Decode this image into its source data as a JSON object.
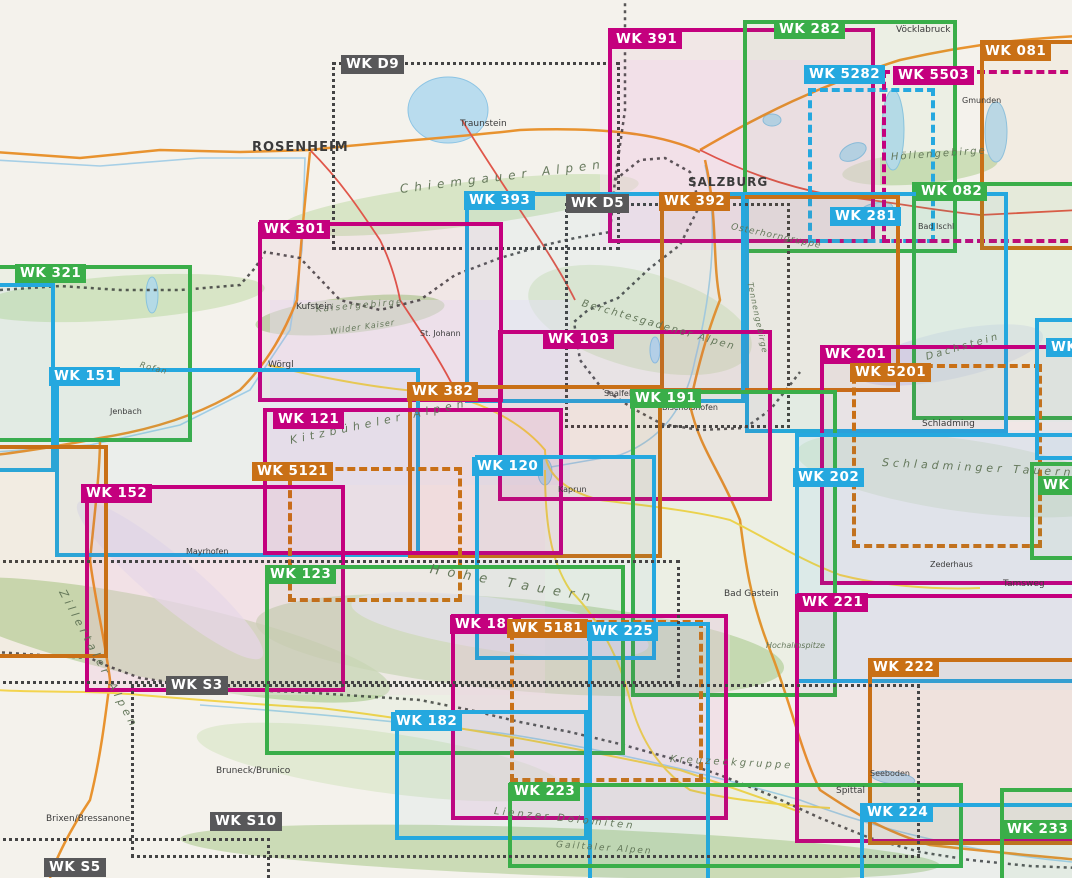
{
  "palette": {
    "magenta": "#c4007e",
    "green": "#3aae49",
    "cyan": "#25a8df",
    "orange": "#c97016",
    "gray": "#58585a",
    "label_text": "#ffffff",
    "water": "#b9dcee",
    "border_line": "#3c3c3c"
  },
  "sheets": [
    {
      "id": "wk-d9",
      "label": "WK D9",
      "color": "gray",
      "style": "dotted",
      "box": [
        332,
        62,
        288,
        188
      ],
      "label_pos": [
        341,
        55
      ]
    },
    {
      "id": "wk-391",
      "label": "WK 391",
      "color": "magenta",
      "style": "solid",
      "box": [
        608,
        28,
        267,
        215
      ],
      "label_pos": [
        611,
        30
      ]
    },
    {
      "id": "wk-282",
      "label": "WK 282",
      "color": "green",
      "style": "solid",
      "box": [
        743,
        20,
        214,
        233
      ],
      "label_pos": [
        774,
        20
      ]
    },
    {
      "id": "wk-5282",
      "label": "WK 5282",
      "color": "cyan",
      "style": "dashed",
      "box": [
        808,
        88,
        127,
        155
      ],
      "label_pos": [
        804,
        65
      ]
    },
    {
      "id": "wk-5503",
      "label": "WK 5503",
      "color": "magenta",
      "style": "dashed",
      "box": [
        882,
        70,
        198,
        173
      ],
      "label_pos": [
        893,
        66
      ]
    },
    {
      "id": "wk-081",
      "label": "WK 081",
      "color": "orange",
      "style": "solid",
      "box": [
        980,
        40,
        100,
        210
      ],
      "label_pos": [
        980,
        42
      ]
    },
    {
      "id": "wk-082",
      "label": "WK 082",
      "color": "green",
      "style": "solid",
      "box": [
        912,
        182,
        168,
        238
      ],
      "label_pos": [
        916,
        182
      ]
    },
    {
      "id": "wk-281",
      "label": "WK 281",
      "color": "cyan",
      "style": "solid",
      "box": [
        745,
        192,
        263,
        241
      ],
      "label_pos": [
        830,
        207
      ]
    },
    {
      "id": "wk-d5",
      "label": "WK D5",
      "color": "gray",
      "style": "dotted",
      "box": [
        565,
        203,
        225,
        225
      ],
      "label_pos": [
        566,
        194
      ]
    },
    {
      "id": "wk-392",
      "label": "WK 392",
      "color": "orange",
      "style": "solid",
      "box": [
        660,
        195,
        240,
        197
      ],
      "label_pos": [
        659,
        192
      ]
    },
    {
      "id": "wk-393",
      "label": "WK 393",
      "color": "cyan",
      "style": "solid",
      "box": [
        465,
        192,
        280,
        211
      ],
      "label_pos": [
        464,
        191
      ]
    },
    {
      "id": "wk-301",
      "label": "WK 301",
      "color": "magenta",
      "style": "solid",
      "box": [
        258,
        222,
        245,
        180
      ],
      "label_pos": [
        259,
        220
      ]
    },
    {
      "id": "wk-321",
      "label": "WK 321",
      "color": "green",
      "style": "solid",
      "box": [
        -12,
        265,
        204,
        177
      ],
      "label_pos": [
        15,
        264
      ]
    },
    {
      "id": "wk-103",
      "label": "WK 103",
      "color": "magenta",
      "style": "solid",
      "box": [
        498,
        330,
        274,
        171
      ],
      "label_pos": [
        543,
        330
      ]
    },
    {
      "id": "wk-201",
      "label": "WK 201",
      "color": "magenta",
      "style": "solid",
      "box": [
        820,
        345,
        260,
        240
      ],
      "label_pos": [
        820,
        345
      ]
    },
    {
      "id": "wk-5201",
      "label": "WK 5201",
      "color": "orange",
      "style": "dashed",
      "box": [
        852,
        364,
        190,
        184
      ],
      "label_pos": [
        850,
        363
      ]
    },
    {
      "id": "wk-151",
      "label": "WK 151",
      "color": "cyan",
      "style": "solid",
      "box": [
        55,
        368,
        365,
        189
      ],
      "label_pos": [
        49,
        367
      ]
    },
    {
      "id": "wk-382",
      "label": "WK 382",
      "color": "orange",
      "style": "solid",
      "box": [
        408,
        385,
        254,
        173
      ],
      "label_pos": [
        407,
        382
      ]
    },
    {
      "id": "wk-191",
      "label": "WK 191",
      "color": "green",
      "style": "solid",
      "box": [
        631,
        390,
        206,
        307
      ],
      "label_pos": [
        630,
        389
      ]
    },
    {
      "id": "wk-121",
      "label": "WK 121",
      "color": "magenta",
      "style": "solid",
      "box": [
        263,
        408,
        300,
        147
      ],
      "label_pos": [
        273,
        410
      ]
    },
    {
      "id": "wk-120",
      "label": "WK 120",
      "color": "cyan",
      "style": "solid",
      "box": [
        475,
        455,
        181,
        205
      ],
      "label_pos": [
        472,
        457
      ]
    },
    {
      "id": "wk-202",
      "label": "WK 202",
      "color": "cyan",
      "style": "solid",
      "box": [
        795,
        433,
        285,
        250
      ],
      "label_pos": [
        793,
        468
      ]
    },
    {
      "id": "wk-5121",
      "label": "WK 5121",
      "color": "orange",
      "style": "dashed",
      "box": [
        288,
        467,
        174,
        135
      ],
      "label_pos": [
        252,
        462
      ]
    },
    {
      "id": "wk-152",
      "label": "WK 152",
      "color": "magenta",
      "style": "solid",
      "box": [
        85,
        485,
        260,
        207
      ],
      "label_pos": [
        81,
        484
      ]
    },
    {
      "id": "wk-123",
      "label": "WK 123",
      "color": "green",
      "style": "solid",
      "box": [
        265,
        565,
        360,
        190
      ],
      "label_pos": [
        265,
        565
      ]
    },
    {
      "id": "wk-221",
      "label": "WK 221",
      "color": "magenta",
      "style": "solid",
      "box": [
        795,
        594,
        285,
        249
      ],
      "label_pos": [
        797,
        593
      ]
    },
    {
      "id": "wk-181",
      "label": "WK 181",
      "color": "magenta",
      "style": "solid",
      "box": [
        451,
        614,
        277,
        206
      ],
      "label_pos": [
        450,
        615
      ]
    },
    {
      "id": "wk-5181",
      "label": "WK 5181",
      "color": "orange",
      "style": "dashed",
      "box": [
        510,
        620,
        193,
        162
      ],
      "label_pos": [
        507,
        619
      ]
    },
    {
      "id": "wk-225",
      "label": "WK 225",
      "color": "cyan",
      "style": "solid",
      "box": [
        588,
        622,
        122,
        268
      ],
      "label_pos": [
        587,
        622
      ]
    },
    {
      "id": "wk-222",
      "label": "WK 222",
      "color": "orange",
      "style": "solid",
      "box": [
        868,
        658,
        212,
        187
      ],
      "label_pos": [
        868,
        658
      ]
    },
    {
      "id": "wk-s3",
      "label": "WK S3",
      "color": "gray",
      "style": "dotted",
      "box": [
        -10,
        560,
        690,
        124
      ],
      "label_pos": [
        166,
        676
      ]
    },
    {
      "id": "wk-182",
      "label": "WK 182",
      "color": "cyan",
      "style": "solid",
      "box": [
        395,
        710,
        193,
        130
      ],
      "label_pos": [
        391,
        712
      ]
    },
    {
      "id": "wk-223",
      "label": "WK 223",
      "color": "green",
      "style": "solid",
      "box": [
        508,
        783,
        455,
        85
      ],
      "label_pos": [
        509,
        782
      ]
    },
    {
      "id": "wk-224",
      "label": "WK 224",
      "color": "cyan",
      "style": "solid",
      "box": [
        860,
        803,
        220,
        87
      ],
      "label_pos": [
        862,
        803
      ]
    },
    {
      "id": "wk-s10",
      "label": "WK S10",
      "color": "gray",
      "style": "dotted",
      "box": [
        131,
        684,
        789,
        174
      ],
      "label_pos": [
        210,
        812
      ]
    },
    {
      "id": "wk-233",
      "label": "WK 233",
      "color": "green",
      "style": "solid",
      "box": [
        1000,
        788,
        80,
        102
      ],
      "label_pos": [
        1002,
        820
      ]
    },
    {
      "id": "wk-s5",
      "label": "WK S5",
      "color": "gray",
      "style": "dotted",
      "box": [
        -10,
        838,
        280,
        52
      ],
      "label_pos": [
        44,
        858
      ]
    },
    {
      "id": "wk-2-right-upper",
      "label": "WK 2",
      "color": "cyan",
      "style": "solid",
      "box": [
        1035,
        318,
        45,
        142
      ],
      "label_pos": [
        1046,
        338
      ]
    },
    {
      "id": "wk-2-right-lower",
      "label": "WK 2",
      "color": "green",
      "style": "solid",
      "box": [
        1030,
        462,
        50,
        98
      ],
      "label_pos": [
        1038,
        476
      ]
    },
    {
      "id": "partial-left-cyan",
      "label": null,
      "color": "cyan",
      "style": "solid",
      "box": [
        -40,
        283,
        95,
        189
      ],
      "label_pos": null
    },
    {
      "id": "partial-left-orange",
      "label": null,
      "color": "orange",
      "style": "solid",
      "box": [
        -40,
        445,
        148,
        213
      ],
      "label_pos": null
    }
  ],
  "cities": [
    {
      "name": "ROSENHEIM",
      "x": 252,
      "y": 140,
      "size": 13,
      "major": true
    },
    {
      "name": "SALZBURG",
      "x": 688,
      "y": 175,
      "size": 12,
      "major": true
    },
    {
      "name": "Traunstein",
      "x": 460,
      "y": 119,
      "size": 9,
      "major": false
    },
    {
      "name": "Vöcklabruck",
      "x": 896,
      "y": 25,
      "size": 9,
      "major": false
    },
    {
      "name": "Gmunden",
      "x": 962,
      "y": 96,
      "size": 8,
      "major": false
    },
    {
      "name": "Bad Ischl",
      "x": 918,
      "y": 222,
      "size": 8,
      "major": false
    },
    {
      "name": "Kufstein",
      "x": 296,
      "y": 302,
      "size": 9,
      "major": false
    },
    {
      "name": "Wörgl",
      "x": 268,
      "y": 360,
      "size": 9,
      "major": false
    },
    {
      "name": "St. Johann",
      "x": 420,
      "y": 329,
      "size": 8,
      "major": false
    },
    {
      "name": "Saalfelden",
      "x": 604,
      "y": 389,
      "size": 8,
      "major": false
    },
    {
      "name": "Bischofshofen",
      "x": 662,
      "y": 403,
      "size": 8,
      "major": false
    },
    {
      "name": "Schladming",
      "x": 922,
      "y": 419,
      "size": 9,
      "major": false
    },
    {
      "name": "Jenbach",
      "x": 110,
      "y": 407,
      "size": 8,
      "major": false
    },
    {
      "name": "Mayrhofen",
      "x": 186,
      "y": 547,
      "size": 8,
      "major": false
    },
    {
      "name": "Kaprun",
      "x": 558,
      "y": 485,
      "size": 8,
      "major": false
    },
    {
      "name": "Bad Gastein",
      "x": 724,
      "y": 589,
      "size": 9,
      "major": false
    },
    {
      "name": "Tamsweg",
      "x": 1003,
      "y": 579,
      "size": 9,
      "major": false
    },
    {
      "name": "Spittal",
      "x": 836,
      "y": 786,
      "size": 9,
      "major": false
    },
    {
      "name": "Seeboden",
      "x": 870,
      "y": 769,
      "size": 8,
      "major": false
    },
    {
      "name": "Bruneck/Brunico",
      "x": 216,
      "y": 766,
      "size": 9,
      "major": false
    },
    {
      "name": "Brixen/Bressanone",
      "x": 46,
      "y": 814,
      "size": 9,
      "major": false
    },
    {
      "name": "Zederhaus",
      "x": 930,
      "y": 560,
      "size": 8,
      "major": false
    }
  ],
  "regions": [
    {
      "name": "Chiemgauer Alpen",
      "x": 400,
      "y": 182,
      "rot": -7,
      "size": 12,
      "sp": 6
    },
    {
      "name": "Kaisergebirge",
      "x": 316,
      "y": 305,
      "rot": -5,
      "size": 9,
      "sp": 2
    },
    {
      "name": "Wilder Kaiser",
      "x": 330,
      "y": 327,
      "rot": -8,
      "size": 8,
      "sp": 1
    },
    {
      "name": "Berchtesgadener Alpen",
      "x": 582,
      "y": 298,
      "rot": 16,
      "size": 10,
      "sp": 2
    },
    {
      "name": "Höllengebirge",
      "x": 891,
      "y": 152,
      "rot": -4,
      "size": 10,
      "sp": 2
    },
    {
      "name": "Osterhorngruppe",
      "x": 731,
      "y": 222,
      "rot": 12,
      "size": 9,
      "sp": 1
    },
    {
      "name": "Tennengebirge",
      "x": 750,
      "y": 278,
      "rot": 78,
      "size": 8,
      "sp": 1
    },
    {
      "name": "Dachstein",
      "x": 926,
      "y": 352,
      "rot": -16,
      "size": 10,
      "sp": 3
    },
    {
      "name": "Kitzbüheler Alpen",
      "x": 290,
      "y": 434,
      "rot": -12,
      "size": 11,
      "sp": 5
    },
    {
      "name": "Hohe Tauern",
      "x": 430,
      "y": 562,
      "rot": 10,
      "size": 13,
      "sp": 8
    },
    {
      "name": "Zillertaler Alpen",
      "x": 62,
      "y": 584,
      "rot": 62,
      "size": 11,
      "sp": 4
    },
    {
      "name": "Schladminger Tauern",
      "x": 882,
      "y": 456,
      "rot": 3,
      "size": 11,
      "sp": 4
    },
    {
      "name": "Hochalmspitze",
      "x": 766,
      "y": 641,
      "rot": 0,
      "size": 8,
      "sp": 0
    },
    {
      "name": "Kreuzeckgruppe",
      "x": 670,
      "y": 754,
      "rot": 3,
      "size": 10,
      "sp": 3
    },
    {
      "name": "Lienzer Dolomiten",
      "x": 494,
      "y": 806,
      "rot": 6,
      "size": 10,
      "sp": 3
    },
    {
      "name": "Gailtaler Alpen",
      "x": 556,
      "y": 840,
      "rot": 4,
      "size": 9,
      "sp": 2
    },
    {
      "name": "Rofan",
      "x": 140,
      "y": 360,
      "rot": 15,
      "size": 8,
      "sp": 1
    }
  ]
}
